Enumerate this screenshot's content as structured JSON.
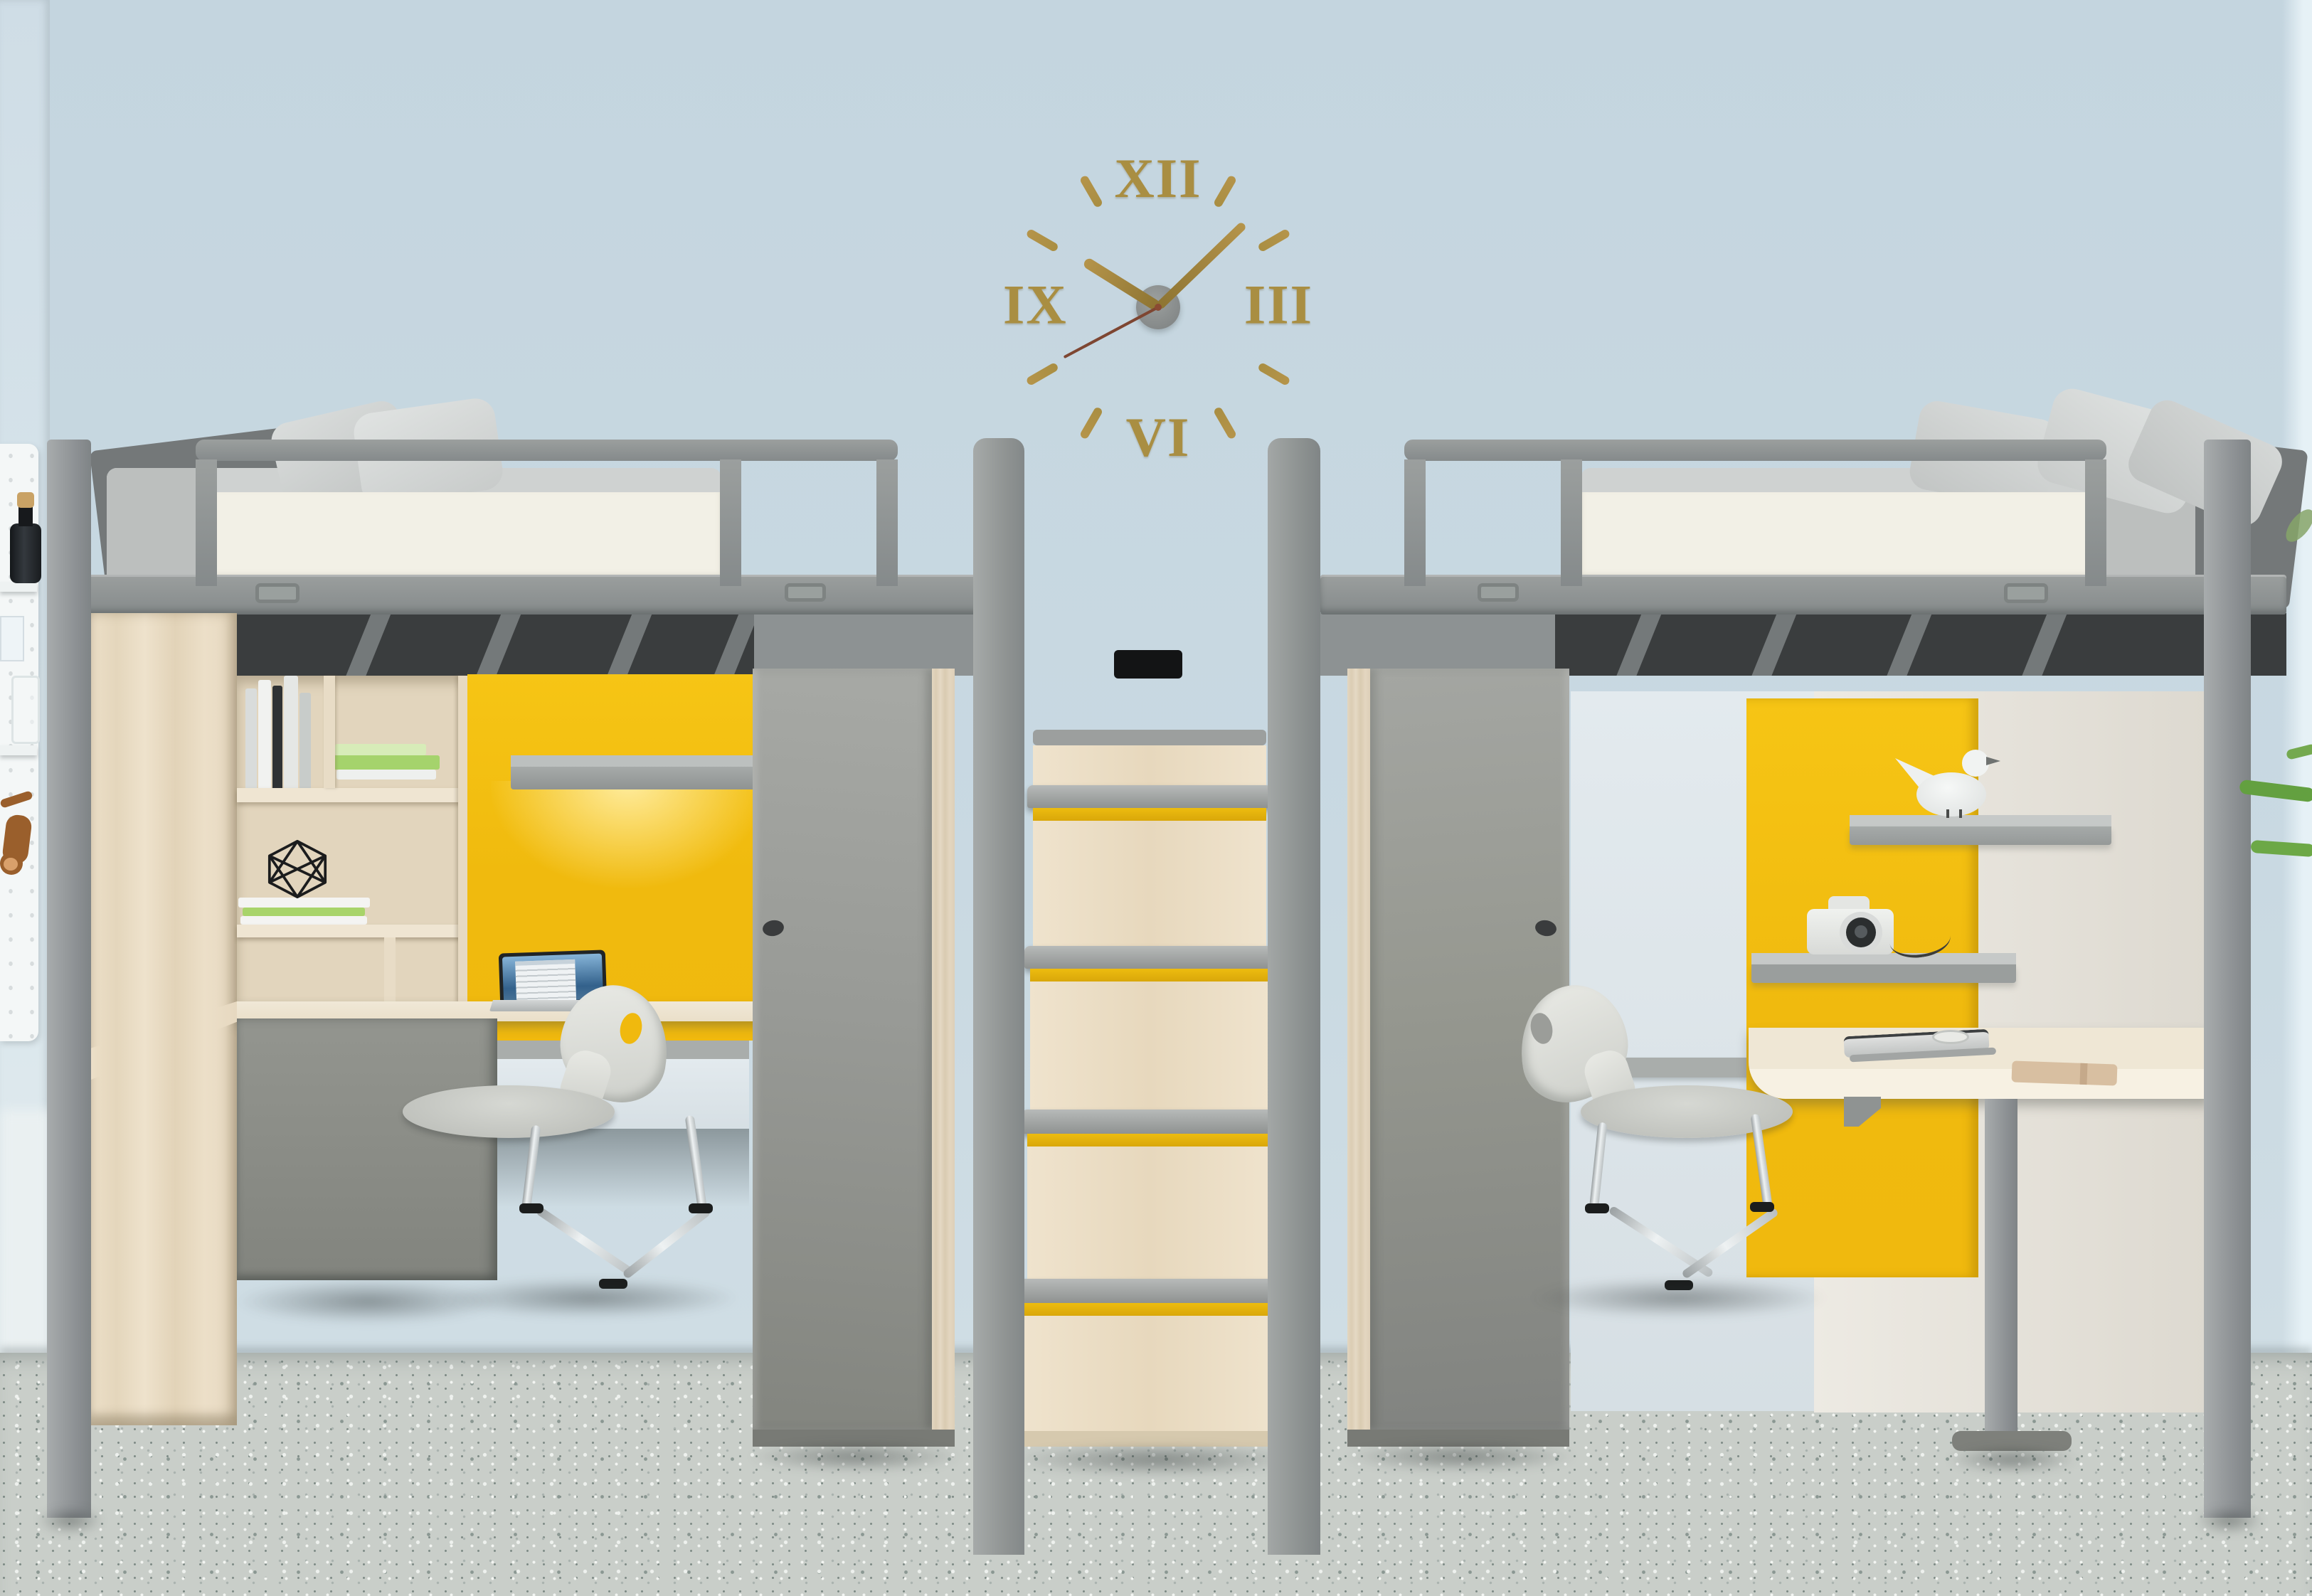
{
  "scene": {
    "description": "3D render of a shared kids/dorm room: two gray loft beds with study nooks under them, yellow accent panels, wood central staircase, wall clock with Roman numerals",
    "units": [
      "left-loft-bed-with-desk",
      "central-staircase",
      "right-loft-bed-with-desk"
    ]
  },
  "clock": {
    "numerals": {
      "top": "XII",
      "right": "III",
      "bottom": "VI",
      "left": "IX"
    },
    "tick_count": 8,
    "approx_time": "10:09",
    "hands": {
      "hour_deg": -58,
      "minute_deg": 46,
      "second_deg": 242
    }
  },
  "colors": {
    "wall": "#c4d5df",
    "floor": "#c9cec9",
    "gold": "#a98e42",
    "yellow": "#f0b90e",
    "stripe": "#edbc0f",
    "frameGray": "#909594",
    "fasciaWhite": "#f2f0e6",
    "wood": "#e9dcc3",
    "wardrobeGray": "#9d9f9b",
    "chairShell": "#e6e7e2",
    "chrome": "#c9ced0",
    "screenBlue": "#33618b",
    "plantGreen": "#63a040",
    "secondHand": "#7e4632"
  }
}
